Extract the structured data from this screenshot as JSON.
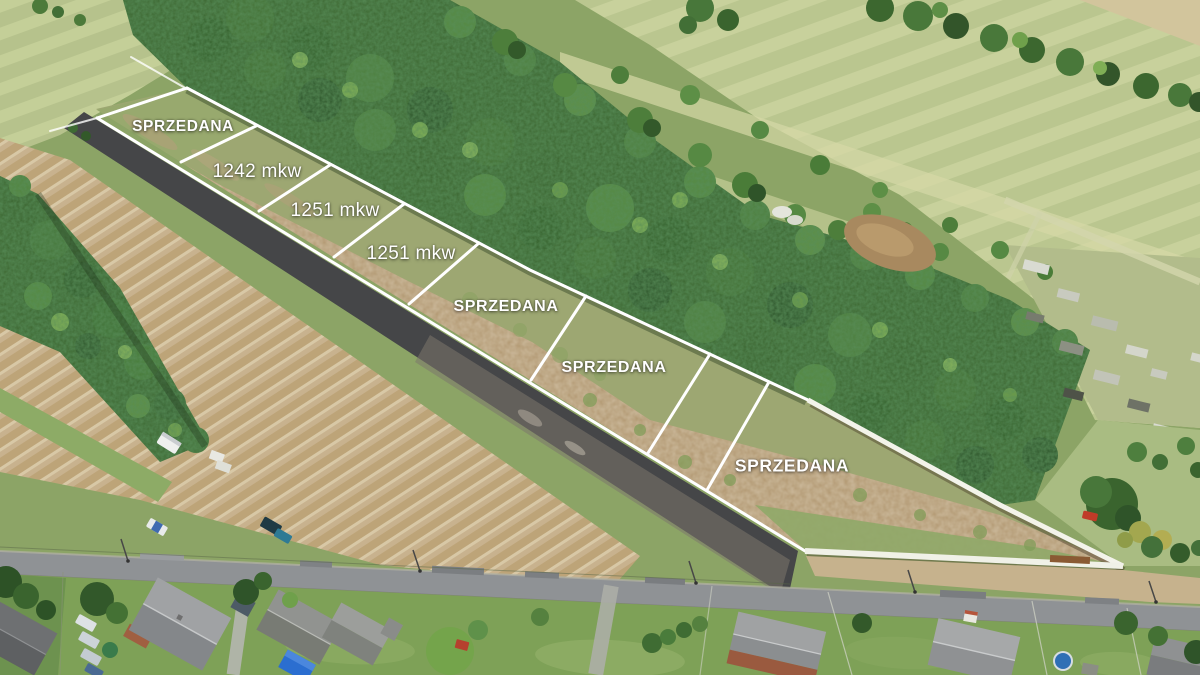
{
  "overlay": {
    "label_color": "#ffffff",
    "labels": [
      {
        "text": "SPRZEDANA",
        "type": "status-sold"
      },
      {
        "text": "1242 mkw",
        "type": "area"
      },
      {
        "text": "1251 mkw",
        "type": "area"
      },
      {
        "text": "1251 mkw",
        "type": "area"
      },
      {
        "text": "SPRZEDANA",
        "type": "status-sold"
      },
      {
        "text": "SPRZEDANA",
        "type": "status-sold"
      },
      {
        "text": "SPRZEDANA",
        "type": "status-sold"
      }
    ]
  }
}
